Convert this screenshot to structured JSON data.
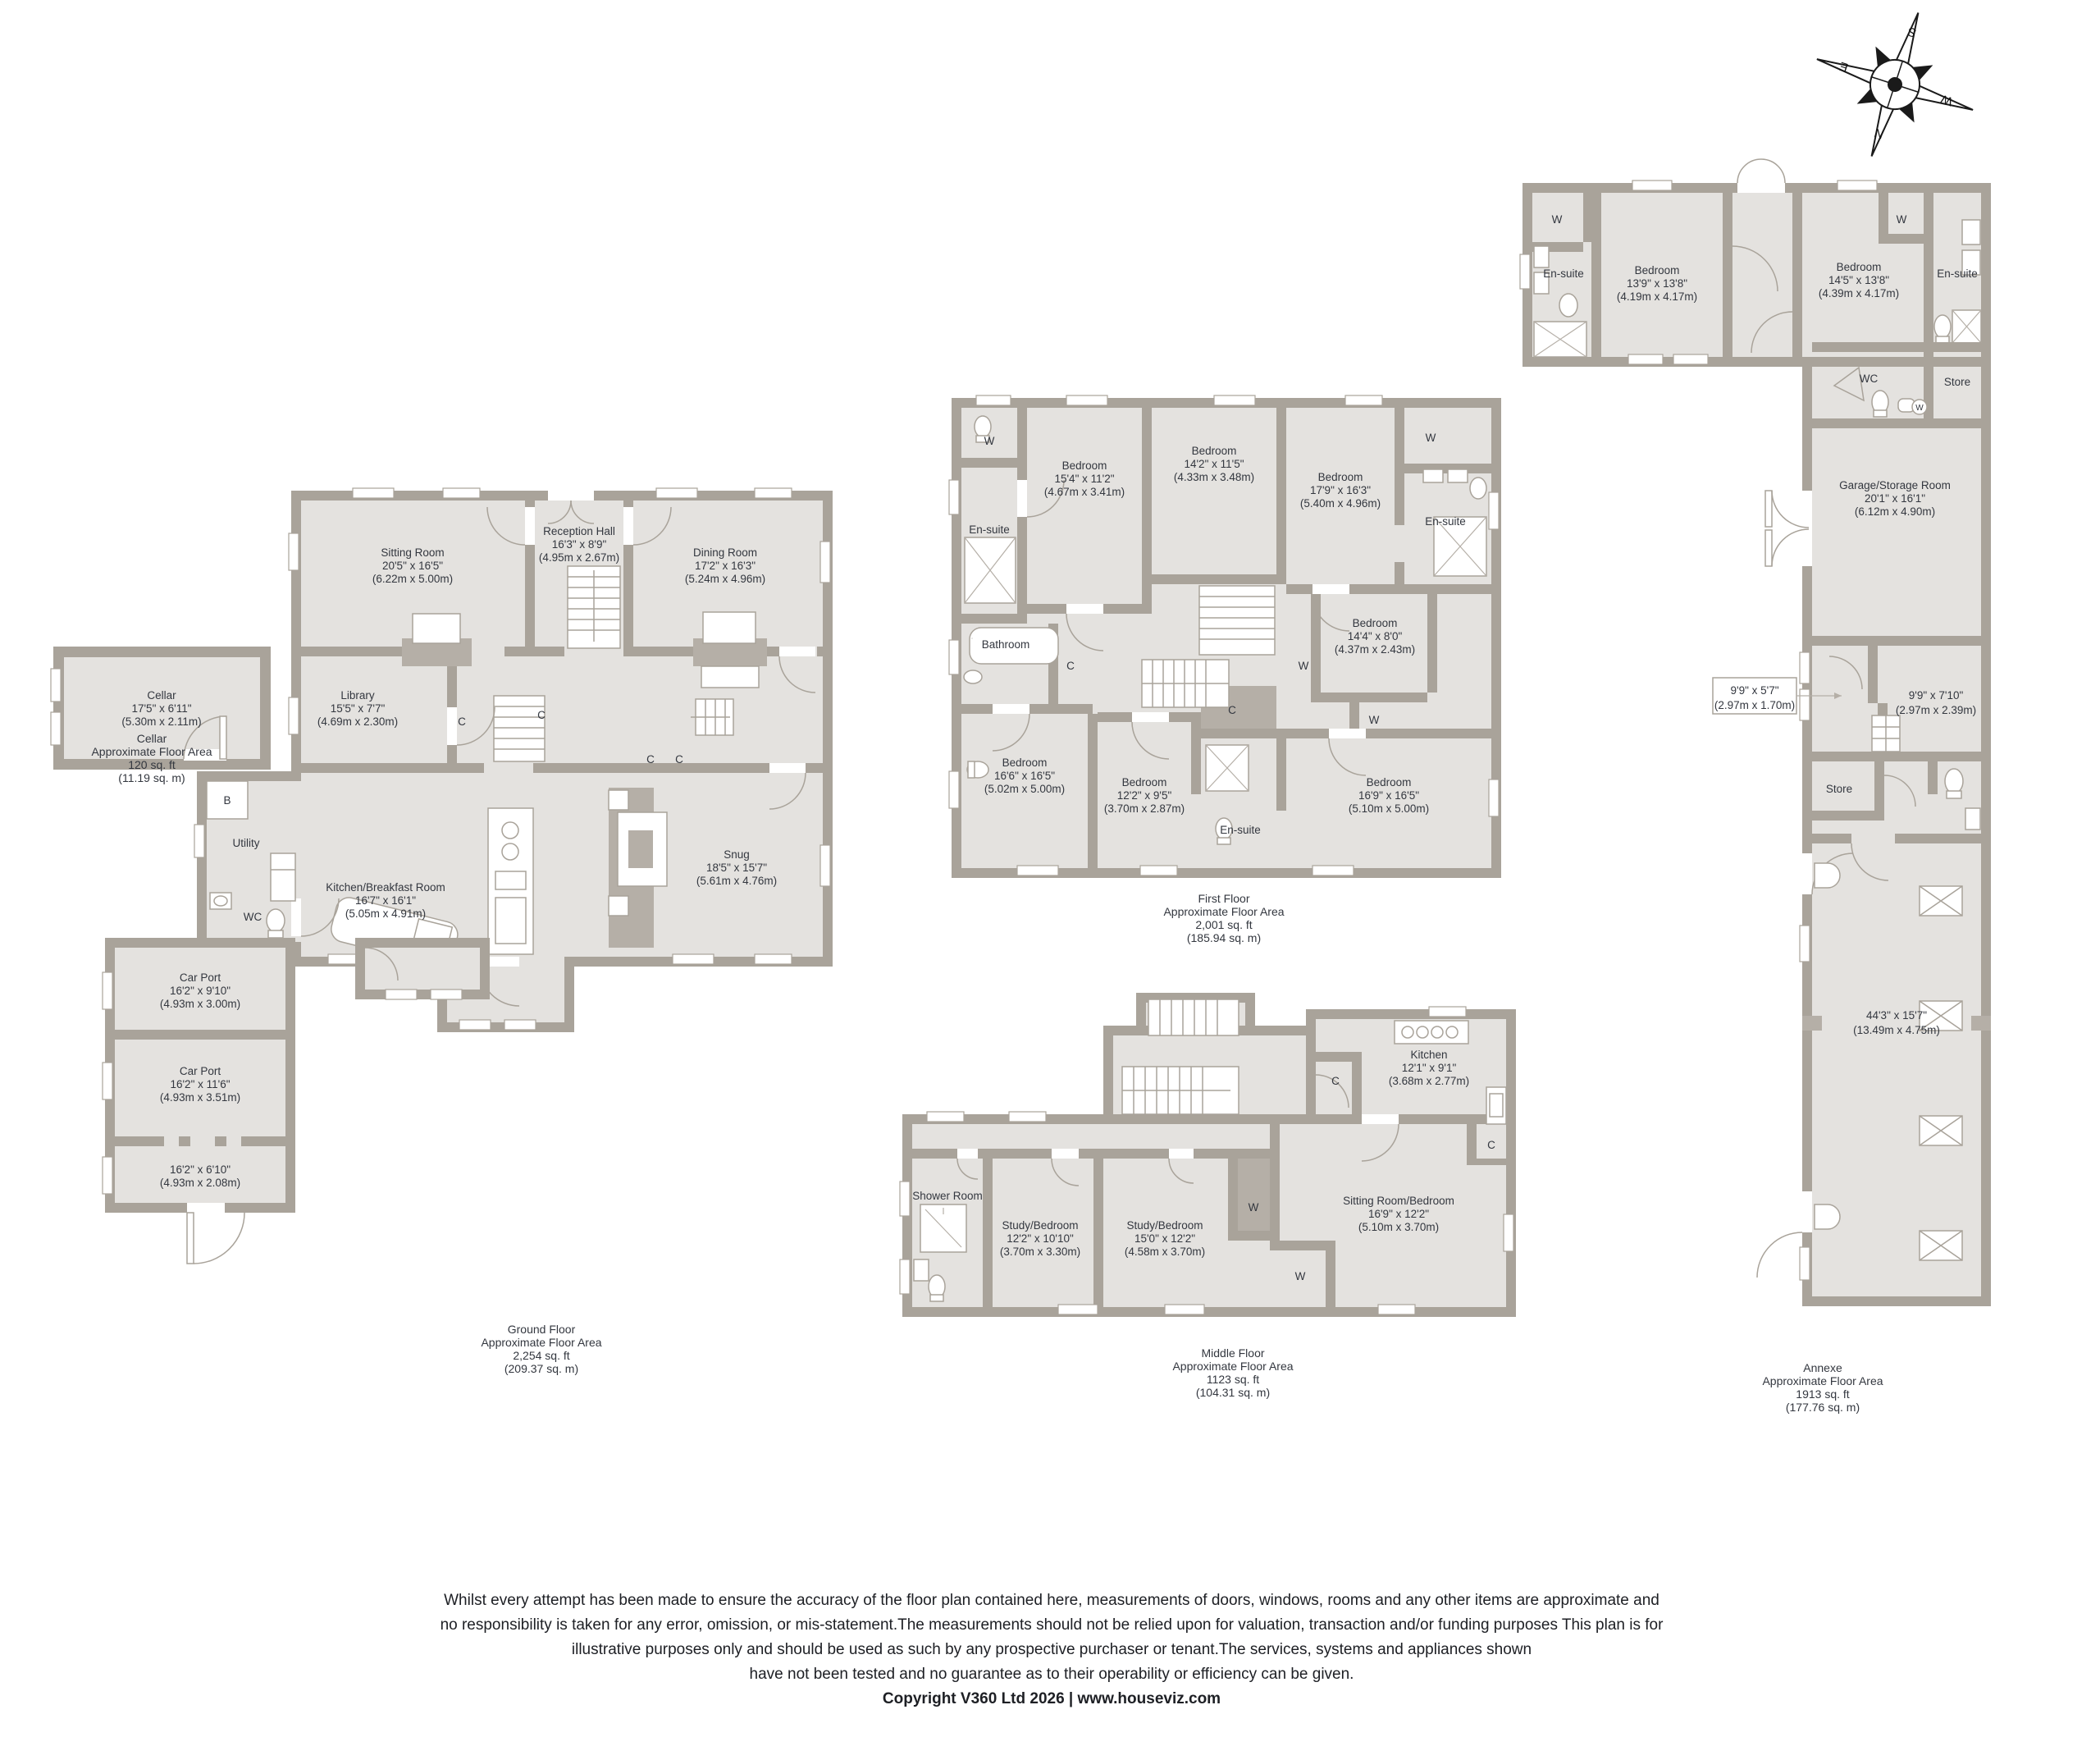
{
  "compass": {
    "n": "N",
    "e": "E",
    "s": "S",
    "w": "W"
  },
  "markers": {
    "b": "B",
    "c": "C",
    "w": "W"
  },
  "cellar": {
    "room": {
      "name": "Cellar",
      "imperial": "17'5\" x 6'11\"",
      "metric": "(5.30m x 2.11m)"
    },
    "caption": [
      "Cellar",
      "Approximate Floor Area",
      "120 sq. ft",
      "(11.19 sq. m)"
    ]
  },
  "ground": {
    "caption": [
      "Ground Floor",
      "Approximate Floor Area",
      "2,254 sq. ft",
      "(209.37 sq. m)"
    ],
    "sitting_room": {
      "name": "Sitting Room",
      "imperial": "20'5\" x 16'5\"",
      "metric": "(6.22m x 5.00m)"
    },
    "reception_hall": {
      "name": "Reception Hall",
      "imperial": "16'3\" x 8'9\"",
      "metric": "(4.95m x 2.67m)"
    },
    "dining_room": {
      "name": "Dining Room",
      "imperial": "17'2\" x 16'3\"",
      "metric": "(5.24m x 4.96m)"
    },
    "library": {
      "name": "Library",
      "imperial": "15'5\" x 7'7\"",
      "metric": "(4.69m x 2.30m)"
    },
    "kitchen": {
      "name": "Kitchen/Breakfast Room",
      "imperial": "16'7\" x 16'1\"",
      "metric": "(5.05m x 4.91m)"
    },
    "snug": {
      "name": "Snug",
      "imperial": "18'5\" x 15'7\"",
      "metric": "(5.61m x 4.76m)"
    },
    "utility": {
      "name": "Utility"
    },
    "wc": {
      "name": "WC"
    },
    "car_port_1": {
      "name": "Car Port",
      "imperial": "16'2\" x 9'10\"",
      "metric": "(4.93m x 3.00m)"
    },
    "car_port_2": {
      "name": "Car Port",
      "imperial": "16'2\" x 11'6\"",
      "metric": "(4.93m x 3.51m)"
    },
    "car_store": {
      "imperial": "16'2\" x 6'10\"",
      "metric": "(4.93m x 2.08m)"
    }
  },
  "first": {
    "caption": [
      "First Floor",
      "Approximate Floor Area",
      "2,001 sq. ft",
      "(185.94 sq. m)"
    ],
    "bedroom_1": {
      "name": "Bedroom",
      "imperial": "15'4\" x 11'2\"",
      "metric": "(4.67m x 3.41m)"
    },
    "bedroom_2": {
      "name": "Bedroom",
      "imperial": "14'2\" x 11'5\"",
      "metric": "(4.33m x 3.48m)"
    },
    "bedroom_3": {
      "name": "Bedroom",
      "imperial": "17'9\" x 16'3\"",
      "metric": "(5.40m x 4.96m)"
    },
    "bedroom_4": {
      "name": "Bedroom",
      "imperial": "14'4\" x 8'0\"",
      "metric": "(4.37m x 2.43m)"
    },
    "bedroom_5": {
      "name": "Bedroom",
      "imperial": "16'6\" x 16'5\"",
      "metric": "(5.02m x 5.00m)"
    },
    "bedroom_6": {
      "name": "Bedroom",
      "imperial": "12'2\" x 9'5\"",
      "metric": "(3.70m x 2.87m)"
    },
    "bedroom_7": {
      "name": "Bedroom",
      "imperial": "16'9\" x 16'5\"",
      "metric": "(5.10m x 5.00m)"
    },
    "ensuite": "En-suite",
    "bathroom": "Bathroom"
  },
  "middle": {
    "caption": [
      "Middle Floor",
      "Approximate Floor Area",
      "1123 sq. ft",
      "(104.31 sq. m)"
    ],
    "kitchen": {
      "name": "Kitchen",
      "imperial": "12'1\" x 9'1\"",
      "metric": "(3.68m x 2.77m)"
    },
    "shower_room": {
      "name": "Shower Room"
    },
    "study_1": {
      "name": "Study/Bedroom",
      "imperial": "12'2\" x 10'10\"",
      "metric": "(3.70m x 3.30m)"
    },
    "study_2": {
      "name": "Study/Bedroom",
      "imperial": "15'0\" x 12'2\"",
      "metric": "(4.58m x 3.70m)"
    },
    "sitting_bedroom": {
      "name": "Sitting Room/Bedroom",
      "imperial": "16'9\" x 12'2\"",
      "metric": "(5.10m x 3.70m)"
    }
  },
  "annexe": {
    "caption": [
      "Annexe",
      "Approximate Floor Area",
      "1913 sq. ft",
      "(177.76 sq. m)"
    ],
    "bedroom_a": {
      "name": "Bedroom",
      "imperial": "13'9\" x 13'8\"",
      "metric": "(4.19m x 4.17m)"
    },
    "bedroom_b": {
      "name": "Bedroom",
      "imperial": "14'5\" x 13'8\"",
      "metric": "(4.39m x 4.17m)"
    },
    "ensuite": "En-suite",
    "wc": "WC",
    "store": "Store",
    "garage": {
      "name": "Garage/Storage Room",
      "imperial": "20'1\" x 16'1\"",
      "metric": "(6.12m x 4.90m)"
    },
    "hall_box": {
      "imperial": "9'9\" x 5'7\"",
      "metric": "(2.97m x 1.70m)"
    },
    "small_room": {
      "imperial": "9'9\" x 7'10\"",
      "metric": "(2.97m x 2.39m)"
    },
    "big_room": {
      "imperial": "44'3\" x 15'7\"",
      "metric": "(13.49m x 4.75m)"
    }
  },
  "disclaimer": {
    "line1": "Whilst every attempt has been made to ensure the accuracy of the floor plan contained here, measurements of doors, windows, rooms and any other items are approximate and",
    "line2": "no responsibility is taken for any error, omission, or mis-statement.The measurements should not be relied upon for valuation, transaction and/or funding purposes This plan is for",
    "line3": "illustrative purposes only and should be used as such by any prospective purchaser or tenant.The services, systems and appliances shown",
    "line4": "have not been tested and no guarantee as to their operability or efficiency can be given.",
    "line5": "Copyright V360 Ltd 2026 | www.houseviz.com"
  }
}
